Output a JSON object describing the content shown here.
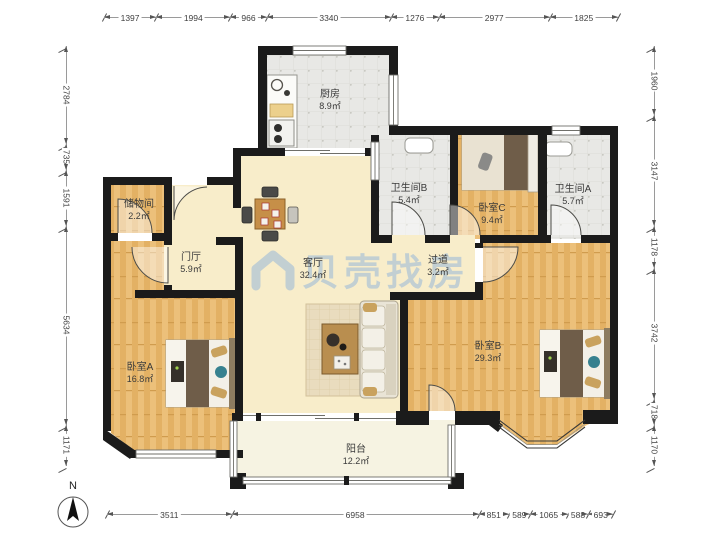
{
  "floorplan": {
    "watermark": "贝壳找房",
    "compass_label": "N",
    "rooms": [
      {
        "id": "kitchen",
        "name": "厨房",
        "area": "8.9㎡"
      },
      {
        "id": "bath-b",
        "name": "卫生间B",
        "area": "5.4㎡"
      },
      {
        "id": "bed-c",
        "name": "卧室C",
        "area": "9.4㎡"
      },
      {
        "id": "bath-a",
        "name": "卫生间A",
        "area": "5.7㎡"
      },
      {
        "id": "storage",
        "name": "储物间",
        "area": "2.2㎡"
      },
      {
        "id": "foyer",
        "name": "门厅",
        "area": "5.9㎡"
      },
      {
        "id": "living",
        "name": "客厅",
        "area": "32.4㎡"
      },
      {
        "id": "corridor",
        "name": "过道",
        "area": "3.2㎡"
      },
      {
        "id": "bed-a",
        "name": "卧室A",
        "area": "16.8㎡"
      },
      {
        "id": "bed-b",
        "name": "卧室B",
        "area": "29.3㎡"
      },
      {
        "id": "balcony",
        "name": "阳台",
        "area": "12.2㎡"
      }
    ],
    "dimensions_mm": {
      "top": [
        1397,
        1994,
        966,
        3340,
        1276,
        2977,
        1825
      ],
      "bottom": [
        3511,
        6958,
        851,
        589,
        1065,
        588,
        693
      ],
      "left": [
        2784,
        735,
        1591,
        5634,
        1171
      ],
      "right": [
        1960,
        3147,
        1178,
        3742,
        718,
        1170
      ]
    },
    "colors": {
      "wall": "#1b1b1b",
      "wood_floor": "#eaba72",
      "living_floor": "#f8edca",
      "tile_floor": "#e8e8e5",
      "balcony_floor": "#f6f3e2",
      "watermark_blue": "#8db2d8",
      "accent_teal": "#37818f"
    }
  }
}
